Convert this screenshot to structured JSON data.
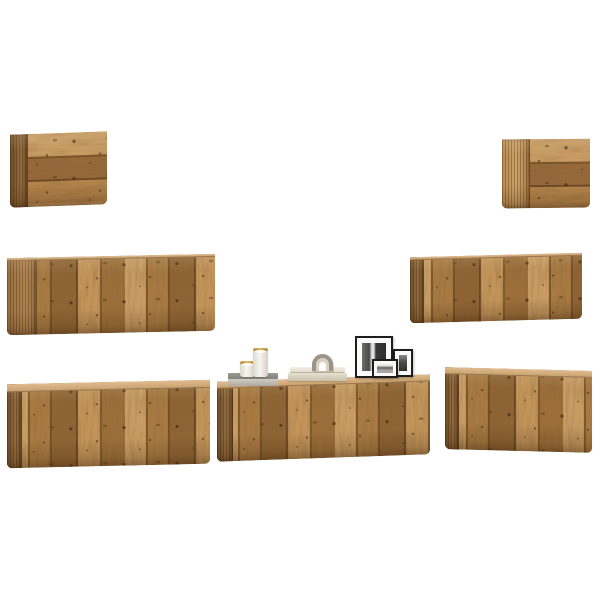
{
  "scene": {
    "description": "Seven-piece wall-mounted TV cabinet set in rustic reclaimed-look wood, floating on a plain white background, decorated with candles, magazines, books, an arch ornament and black photo frames",
    "background_color": "#ffffff",
    "cabinet_count": 7
  },
  "palette": {
    "wood_light": "#c79b63",
    "wood_mid": "#a87a42",
    "wood_dark": "#8f6434",
    "wood_joint": "#6e4a24",
    "wood_side": "#8a6236",
    "wood_top": "#d0a876",
    "knot": "#46290e",
    "candle_white": "#f2efe9",
    "candle_rim_gold": "#c9a24a",
    "magazine_gray_dark": "#8b8a84",
    "magazine_gray_light": "#c6c3bc",
    "book_cream": "#f0ece3",
    "book_tan": "#d5ccb8",
    "arch_outer": "#9d9487",
    "arch_inner": "#d8d1c5",
    "frame_black": "#1d1d1b",
    "frame_mat": "#fafafa"
  },
  "cabinets": [
    {
      "name": "wall-cabinet-top-left",
      "label": "small wall cabinet",
      "x": 10,
      "y": 133,
      "w": 97,
      "h": 73,
      "skew": -2,
      "side_w": 18,
      "side_tone": "dark",
      "grain": "h",
      "top_sliver": 0
    },
    {
      "name": "wall-cabinet-top-right",
      "label": "small wall cabinet",
      "x": 502,
      "y": 139,
      "w": 88,
      "h": 69,
      "skew": -0.5,
      "side_w": 28,
      "side_tone": "light",
      "grain": "h",
      "top_sliver": 0
    },
    {
      "name": "wall-cabinet-mid-left",
      "label": "wall cabinet",
      "x": 7,
      "y": 256,
      "w": 208,
      "h": 77,
      "skew": -1.2,
      "side_w": 30,
      "side_tone": "medium",
      "grain": "v",
      "top_sliver": 3
    },
    {
      "name": "wall-cabinet-mid-right",
      "label": "wall cabinet",
      "x": 410,
      "y": 255,
      "w": 172,
      "h": 66,
      "skew": -1.5,
      "side_w": 14,
      "side_tone": "dark",
      "grain": "v",
      "top_sliver": 3
    },
    {
      "name": "tv-cabinet-bottom-left",
      "label": "TV bench cabinet",
      "x": 7,
      "y": 382,
      "w": 203,
      "h": 84,
      "skew": -1.3,
      "side_w": 15,
      "side_tone": "dark",
      "grain": "v",
      "top_sliver": 8
    },
    {
      "name": "tv-cabinet-bottom-center",
      "label": "TV bench cabinet",
      "x": 217,
      "y": 378,
      "w": 213,
      "h": 80,
      "skew": -2,
      "side_w": 16,
      "side_tone": "dark",
      "grain": "v",
      "top_sliver": 7
    },
    {
      "name": "tv-cabinet-bottom-right",
      "label": "TV bench cabinet",
      "x": 445,
      "y": 369,
      "w": 147,
      "h": 82,
      "skew": 1.5,
      "side_w": 14,
      "side_tone": "dark",
      "grain": "v",
      "top_sliver": 7
    }
  ],
  "decor": {
    "gray_stack": {
      "label": "gray magazine stack",
      "x": 228,
      "y": 373,
      "w": 50,
      "h": 13
    },
    "candle_small": {
      "label": "small white candle with gold rim",
      "x": 240,
      "y": 361,
      "w": 15,
      "h": 16
    },
    "candle_tall": {
      "label": "tall white candle with gold rim",
      "x": 253,
      "y": 348,
      "w": 15,
      "h": 29
    },
    "white_books": {
      "label": "stack of cream books",
      "x": 288,
      "y": 367,
      "w": 59,
      "h": 14
    },
    "arch_ornament": {
      "label": "taupe arch ornament",
      "x": 312,
      "y": 354,
      "w": 21,
      "h": 17
    },
    "frame_large": {
      "label": "large black photo frame, B&W city photo",
      "x": 355,
      "y": 336,
      "w": 38,
      "h": 42
    },
    "frame_medium": {
      "label": "medium black photo frame, dark photo",
      "x": 393,
      "y": 349,
      "w": 20,
      "h": 28
    },
    "frame_small": {
      "label": "small black photo frame, landscape cityscape",
      "x": 372,
      "y": 359,
      "w": 26,
      "h": 19
    }
  }
}
